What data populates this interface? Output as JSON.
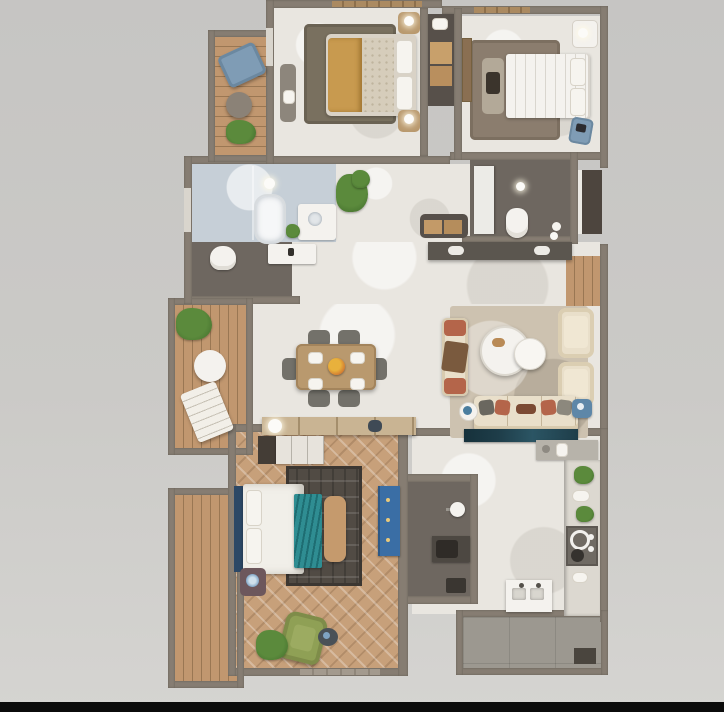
{
  "scene": {
    "type": "3d-rendered-apartment-floor-plan-top-view",
    "visible_text": "none",
    "letterbox_note": "black strip along very bottom edge"
  },
  "palette": {
    "bg-top": "#c6c5c3",
    "bg-mid": "#cbcac7",
    "bg-bottom": "#d5d4d1",
    "letterbox": "#0b0b0b",
    "wall": "#867d72",
    "wall-dark": "#6b6359",
    "window-light": "#d9d5cd",
    "window-wood": "#ab8a61",
    "marble": "#e9e6e0",
    "bath-marble": "#c6cfd7",
    "dark-floor": "#6e6760",
    "deck-wood": "#c1976f",
    "deck-seam": "#9a7753",
    "herringbone": "#c7a07a",
    "tile-floor": "#9c9890",
    "rug-bedroom1": "#79705f",
    "rug-bedroom2": "#8b7d6e",
    "rug-living": "#cdc2b0",
    "rug-bedroom3": "#514b44",
    "cream": "#e9dfca",
    "terracotta": "#b4654a",
    "teal": "#2f8d92",
    "navy": "#1e3d49",
    "blue-dresser": "#3a6ea5",
    "green-chair": "#8fa055",
    "plant": "#5b8a3c",
    "plant-dark": "#3f6b2a",
    "mustard": "#c89a4f",
    "wood": "#b9996e",
    "wood-light": "#c9b493",
    "white-fixture": "#f4f2ee",
    "gray-chair": "#73716a",
    "blue-chair": "#7f9cb5",
    "steel-blue": "#5e87a8",
    "closet-dark": "#57504a",
    "counter-dark": "#5b564f",
    "counter-gray": "#b7b3aa",
    "counter-light": "#dcd8d0",
    "stove-gray": "#6f6a63"
  },
  "rooms": [
    {
      "id": "balcony-top-left",
      "name": "balcony with lounge chair, table and plant"
    },
    {
      "id": "bedroom-1",
      "name": "bedroom with mustard double bed"
    },
    {
      "id": "bedroom-2",
      "name": "bedroom with white double bed"
    },
    {
      "id": "bathroom-1",
      "name": "bathroom with tub, shower, vanity, toilet"
    },
    {
      "id": "bathroom-2",
      "name": "bathroom with toilet and shower panel"
    },
    {
      "id": "hallway",
      "name": "central hall with console and sideboard"
    },
    {
      "id": "dining-area",
      "name": "dining table with six chairs"
    },
    {
      "id": "living-room",
      "name": "living room with sofa, settee, armchairs, coffee tables, TV console"
    },
    {
      "id": "balcony-left",
      "name": "wood deck balcony with lounger, table, plant"
    },
    {
      "id": "master-bedroom",
      "name": "master bedroom, herringbone floor, teal bed, green armchair"
    },
    {
      "id": "wc",
      "name": "small washroom"
    },
    {
      "id": "kitchen",
      "name": "L-shaped kitchen with stove and sink"
    },
    {
      "id": "service-balcony",
      "name": "tiled service balcony"
    },
    {
      "id": "deck-bottom-left",
      "name": "narrow wood deck"
    }
  ]
}
